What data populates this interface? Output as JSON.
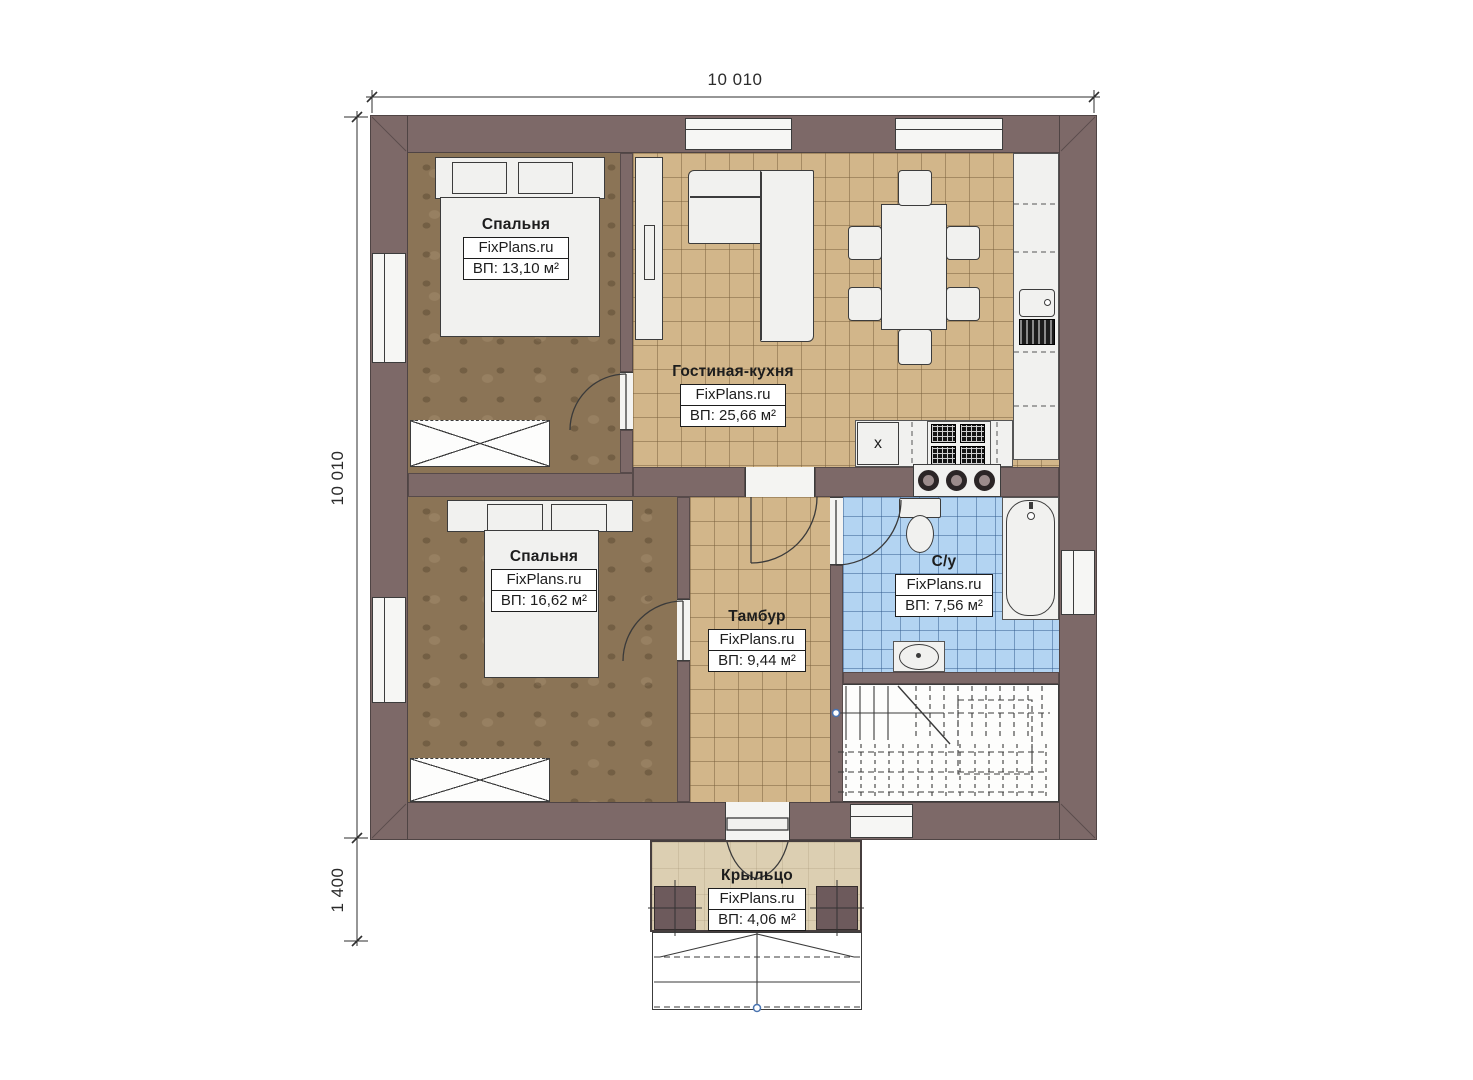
{
  "plan": {
    "source_watermark": "FixPlans.ru",
    "dimensions": {
      "width_total": "10 010",
      "height_total": "10 010",
      "porch_depth": "1 400"
    },
    "rooms": {
      "bedroom1": {
        "name": "Спальня",
        "watermark": "FixPlans.ru",
        "area": "ВП: 13,10 м²"
      },
      "living_kitchen": {
        "name": "Гостиная-кухня",
        "watermark": "FixPlans.ru",
        "area": "ВП: 25,66 м²"
      },
      "bedroom2": {
        "name": "Спальня",
        "watermark": "FixPlans.ru",
        "area": "ВП: 16,62 м²"
      },
      "tambour": {
        "name": "Тамбур",
        "watermark": "FixPlans.ru",
        "area": "ВП: 9,44 м²"
      },
      "bathroom": {
        "name": "С/у",
        "watermark": "FixPlans.ru",
        "area": "ВП: 7,56 м²"
      },
      "porch": {
        "name": "Крыльцо",
        "watermark": "FixPlans.ru",
        "area": "ВП: 4,06 м²"
      }
    },
    "kitchen": {
      "dishwasher_label": "x"
    },
    "colors": {
      "wall": "#7d6968",
      "bedroom_floor": "#8b7456",
      "tile_floor": "#d2b68a",
      "bath_floor": "#b3d4f2",
      "porch_floor": "#dccfb2",
      "handle_accent": "#4a74b0"
    }
  }
}
